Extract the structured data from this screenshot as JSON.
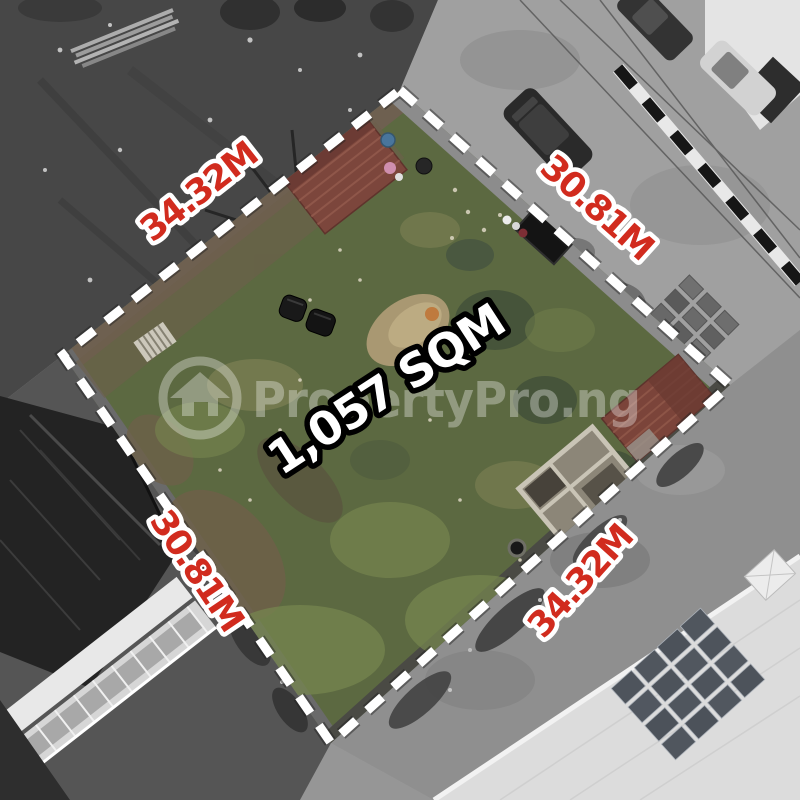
{
  "photo": {
    "description": "Aerial drone photo of a vacant land plot outlined with a white dashed boundary; plot interior in color, surroundings desaturated",
    "area_label": "1,057 SQM",
    "dimensions": {
      "top_left": "34.32M",
      "top_right": "30.81M",
      "bottom_left": "30.81M",
      "bottom_right": "34.32M"
    },
    "watermark": {
      "text": "PropertyPro.ng",
      "logo": "house-in-circle-icon"
    },
    "colors": {
      "dimension_label": "#d12b1e",
      "dimension_label_outline": "#ffffff",
      "area_label": "#ffffff",
      "area_label_outline": "#000000",
      "boundary_dash": "#ffffff",
      "plot_grass": "#5c6941",
      "watermark": "#ffffff"
    }
  }
}
